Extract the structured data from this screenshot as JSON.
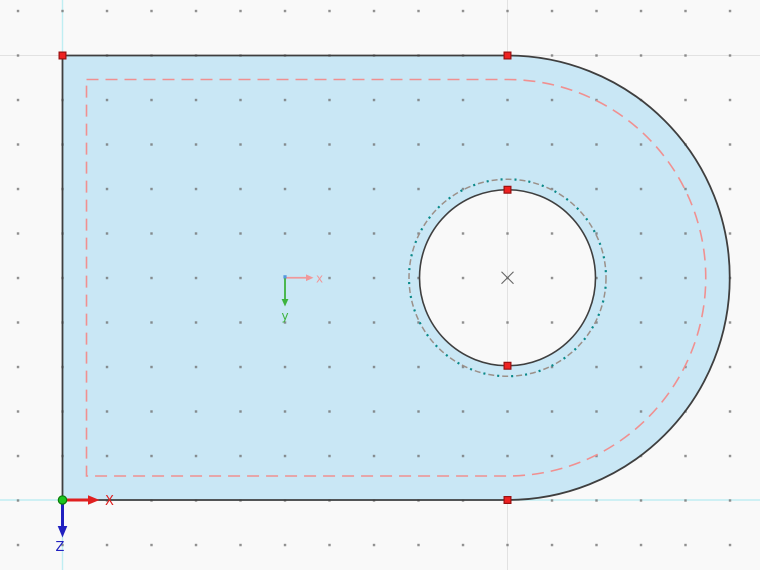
{
  "canvas": {
    "background": "#f9f9f9",
    "width": 760,
    "height": 570
  },
  "colors": {
    "surface_fill": "#c9e7f5",
    "outline": "#3f3f3f",
    "offset_dashed": "#f09090",
    "selection_dash_gray": "#9b9089",
    "selection_dot_teal": "#0a8b8b",
    "node_fill": "#ee2222",
    "node_border": "#991111",
    "grid_dot": "#6f6f6f",
    "grid_major_line": "#e2e2e2",
    "axis_guide_cyan": "#bfeef2",
    "global_axis_x": "#e02020",
    "global_axis_z": "#2020c0",
    "origin_dot_fill": "#1ec51e",
    "origin_dot_border": "#0a7a0a",
    "local_axis_x": "#f0989a",
    "local_axis_y": "#3db33d",
    "local_origin_mark": "#5599dd",
    "center_mark": "#666666"
  },
  "global_axes": {
    "x_label": "X",
    "z_label": "Z"
  },
  "local_axes": {
    "x_label": "x",
    "y_label": "y"
  },
  "nodes": [
    {
      "x": 62.5,
      "y": 55.5,
      "label": "corner-top-left"
    },
    {
      "x": 507.5,
      "y": 55.5,
      "label": "arc-start-top"
    },
    {
      "x": 507.5,
      "y": 500,
      "label": "arc-end-bottom"
    },
    {
      "x": 507.5,
      "y": 189.75,
      "label": "opening-top"
    },
    {
      "x": 507.5,
      "y": 365.75,
      "label": "opening-bottom"
    }
  ]
}
